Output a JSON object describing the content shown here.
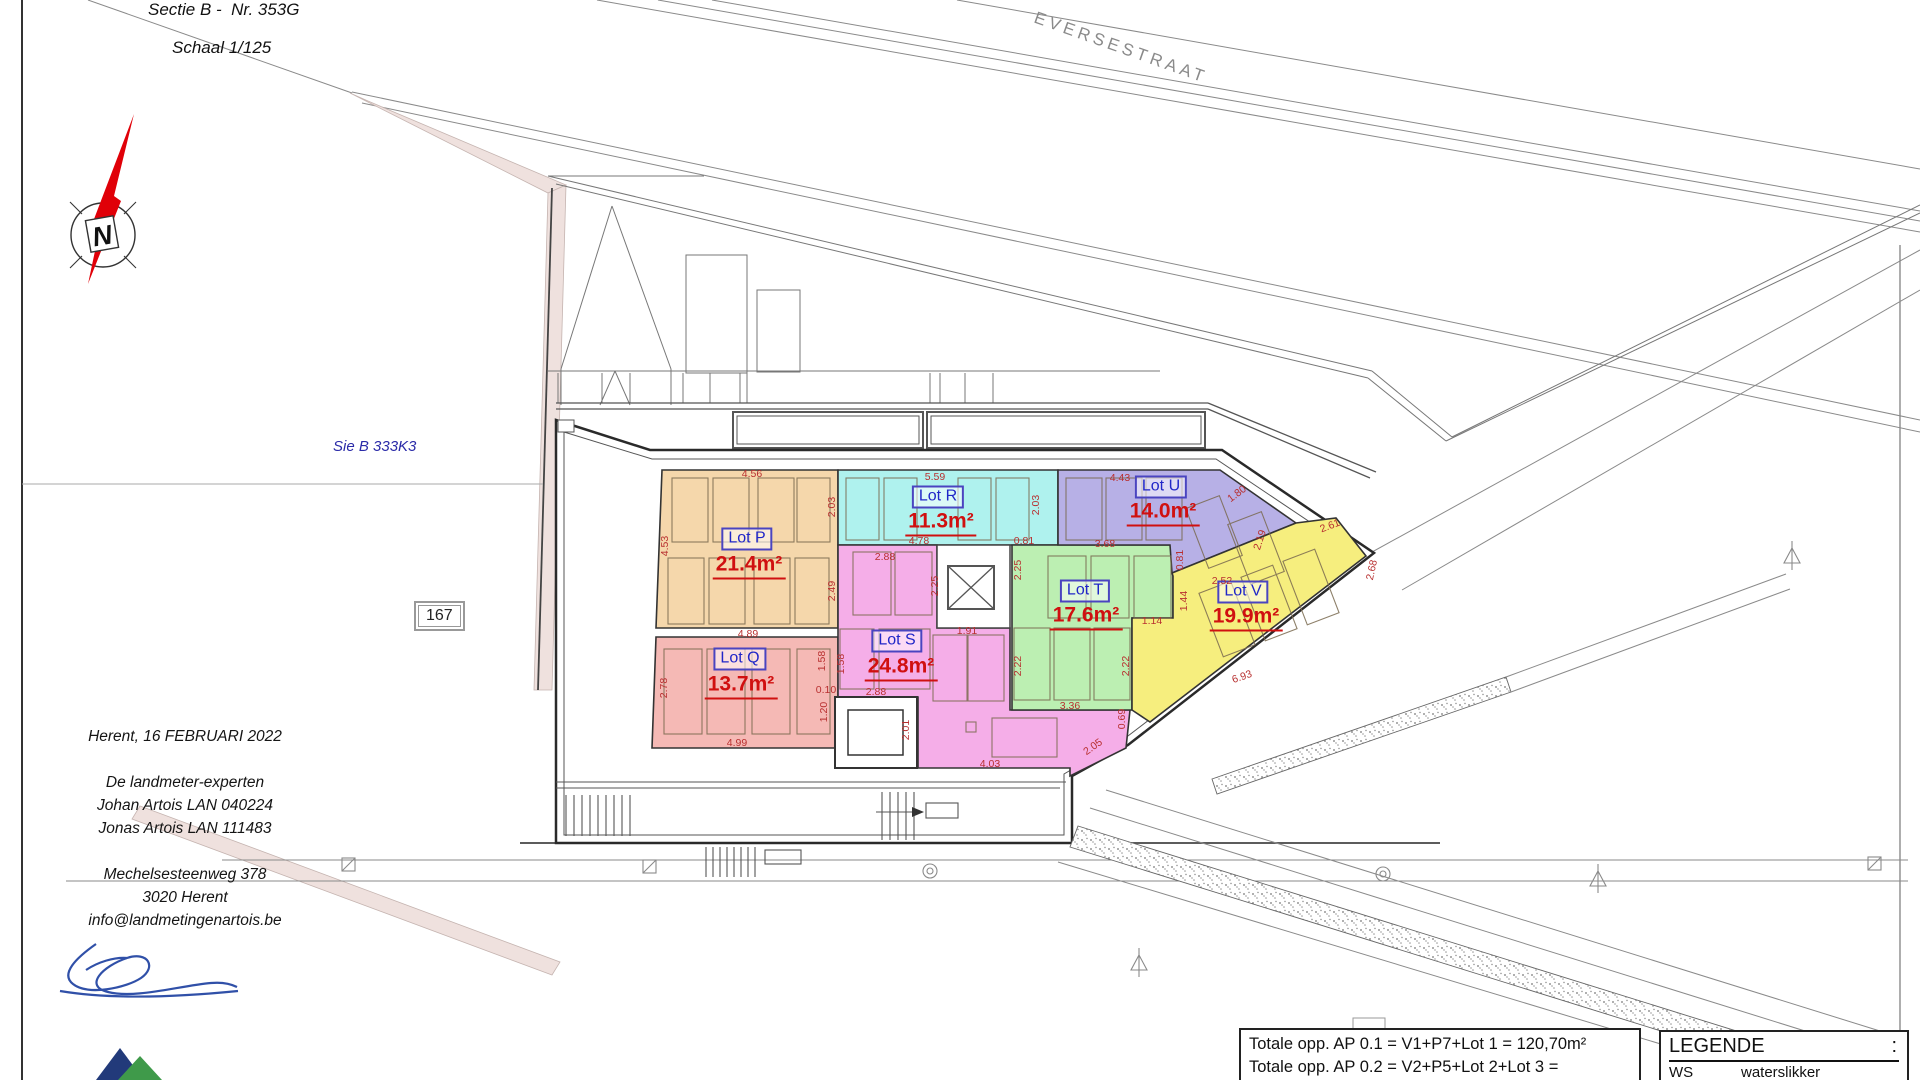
{
  "meta": {
    "sectie": "Sectie B -  Nr. 353G",
    "schaal": "Schaal 1/125",
    "street": "EVERSESTRAAT",
    "parcel_note": "Sie B 333K3",
    "parcel_number": "167",
    "compass_letter": "N"
  },
  "address": {
    "lines": [
      "Herent,  16 FEBRUARI 2022",
      "",
      "De landmeter-experten",
      "Johan Artois LAN 040224",
      "Jonas Artois LAN 111483",
      "",
      "Mechelsesteenweg 378",
      "3020 Herent",
      "info@landmetingenartois.be"
    ]
  },
  "totals": {
    "lines": [
      "Totale opp. AP 0.1 = V1+P7+Lot 1 = 120,70m²",
      "Totale opp. AP 0.2 = V2+P5+Lot 2+Lot 3 = 148,30m²",
      "Totale opp. AP 1.1 = V3+P1+F1+Lot 4 = 118,90m²"
    ]
  },
  "legend": {
    "title": "LEGENDE",
    "colon": ":",
    "rows": [
      {
        "code": "WS",
        "desc": "waterslikker"
      },
      {
        "code": "BS",
        "desc": "bezoeksschouw"
      }
    ]
  },
  "colors": {
    "lot_label_text": "#2026c8",
    "lot_label_border": "#4a44c0",
    "area_text": "#d01010",
    "dimension_text": "#b83030",
    "compass_needle": "#e00008",
    "boundary_strip": "#efe1de",
    "signature_ink": "#3050a8"
  },
  "lots": [
    {
      "id": "P",
      "label": "Lot P",
      "area": "21.4m²",
      "color": "#F5D7AB",
      "lx": 747,
      "ly": 539,
      "ax": 749,
      "ay": 566
    },
    {
      "id": "Q",
      "label": "Lot Q",
      "area": "13.7m²",
      "color": "#F5B9B5",
      "lx": 740,
      "ly": 659,
      "ax": 741,
      "ay": 686
    },
    {
      "id": "R",
      "label": "Lot R",
      "area": "11.3m²",
      "color": "#AFF2EE",
      "lx": 938,
      "ly": 497,
      "ax": 941,
      "ay": 523
    },
    {
      "id": "S",
      "label": "Lot S",
      "area": "24.8m²",
      "color": "#F5AEE8",
      "lx": 897,
      "ly": 641,
      "ax": 901,
      "ay": 668
    },
    {
      "id": "T",
      "label": "Lot T",
      "area": "17.6m²",
      "color": "#BCEFB2",
      "lx": 1085,
      "ly": 591,
      "ax": 1086,
      "ay": 617
    },
    {
      "id": "U",
      "label": "Lot U",
      "area": "14.0m²",
      "color": "#B7B0E6",
      "lx": 1161,
      "ly": 487,
      "ax": 1163,
      "ay": 513
    },
    {
      "id": "V",
      "label": "Lot V",
      "area": "19.9m²",
      "color": "#F6EE7E",
      "lx": 1243,
      "ly": 592,
      "ax": 1246,
      "ay": 618
    }
  ],
  "dimensions": [
    {
      "text": "4.56",
      "x": 752,
      "y": 474,
      "r": 0
    },
    {
      "text": "4.53",
      "x": 665,
      "y": 546,
      "r": -90
    },
    {
      "text": "2.03",
      "x": 832,
      "y": 507,
      "r": -90
    },
    {
      "text": "2.49",
      "x": 832,
      "y": 591,
      "r": -90
    },
    {
      "text": "4.89",
      "x": 748,
      "y": 634,
      "r": 0
    },
    {
      "text": "2.78",
      "x": 664,
      "y": 688,
      "r": -90
    },
    {
      "text": "1.20",
      "x": 824,
      "y": 712,
      "r": -90
    },
    {
      "text": "4.99",
      "x": 737,
      "y": 743,
      "r": 0
    },
    {
      "text": "5.59",
      "x": 935,
      "y": 477,
      "r": 0
    },
    {
      "text": "2.03",
      "x": 1036,
      "y": 505,
      "r": -90
    },
    {
      "text": "4.78",
      "x": 919,
      "y": 541,
      "r": 0
    },
    {
      "text": "0.81",
      "x": 1024,
      "y": 541,
      "r": 0
    },
    {
      "text": "4.43",
      "x": 1120,
      "y": 478,
      "r": 0
    },
    {
      "text": "1.80",
      "x": 1237,
      "y": 494,
      "r": -37
    },
    {
      "text": "3.68",
      "x": 1105,
      "y": 544,
      "r": 0
    },
    {
      "text": "0.81",
      "x": 1180,
      "y": 560,
      "r": -90
    },
    {
      "text": "2.19",
      "x": 1260,
      "y": 540,
      "r": -72
    },
    {
      "text": "2.25",
      "x": 1018,
      "y": 570,
      "r": -90
    },
    {
      "text": "2.22",
      "x": 1018,
      "y": 666,
      "r": -90
    },
    {
      "text": "2.22",
      "x": 1126,
      "y": 666,
      "r": -90
    },
    {
      "text": "3.36",
      "x": 1070,
      "y": 706,
      "r": 0
    },
    {
      "text": "1.14",
      "x": 1152,
      "y": 621,
      "r": 0
    },
    {
      "text": "2.88",
      "x": 885,
      "y": 557,
      "r": 0
    },
    {
      "text": "2.25",
      "x": 935,
      "y": 586,
      "r": -90
    },
    {
      "text": "1.91",
      "x": 967,
      "y": 631,
      "r": 0
    },
    {
      "text": "1.58",
      "x": 822,
      "y": 661,
      "r": -90
    },
    {
      "text": "1.58",
      "x": 841,
      "y": 664,
      "r": -90
    },
    {
      "text": "0.10",
      "x": 826,
      "y": 690,
      "r": 0
    },
    {
      "text": "2.88",
      "x": 876,
      "y": 692,
      "r": 0
    },
    {
      "text": "2.01",
      "x": 906,
      "y": 730,
      "r": -90
    },
    {
      "text": "4.03",
      "x": 990,
      "y": 764,
      "r": 0
    },
    {
      "text": "2.05",
      "x": 1093,
      "y": 747,
      "r": -35
    },
    {
      "text": "0.69",
      "x": 1122,
      "y": 719,
      "r": -90
    },
    {
      "text": "2.52",
      "x": 1222,
      "y": 581,
      "r": 0
    },
    {
      "text": "1.44",
      "x": 1184,
      "y": 601,
      "r": -90
    },
    {
      "text": "2.61",
      "x": 1330,
      "y": 526,
      "r": -21
    },
    {
      "text": "2.68",
      "x": 1372,
      "y": 570,
      "r": -78
    },
    {
      "text": "6.93",
      "x": 1242,
      "y": 677,
      "r": -19
    }
  ]
}
